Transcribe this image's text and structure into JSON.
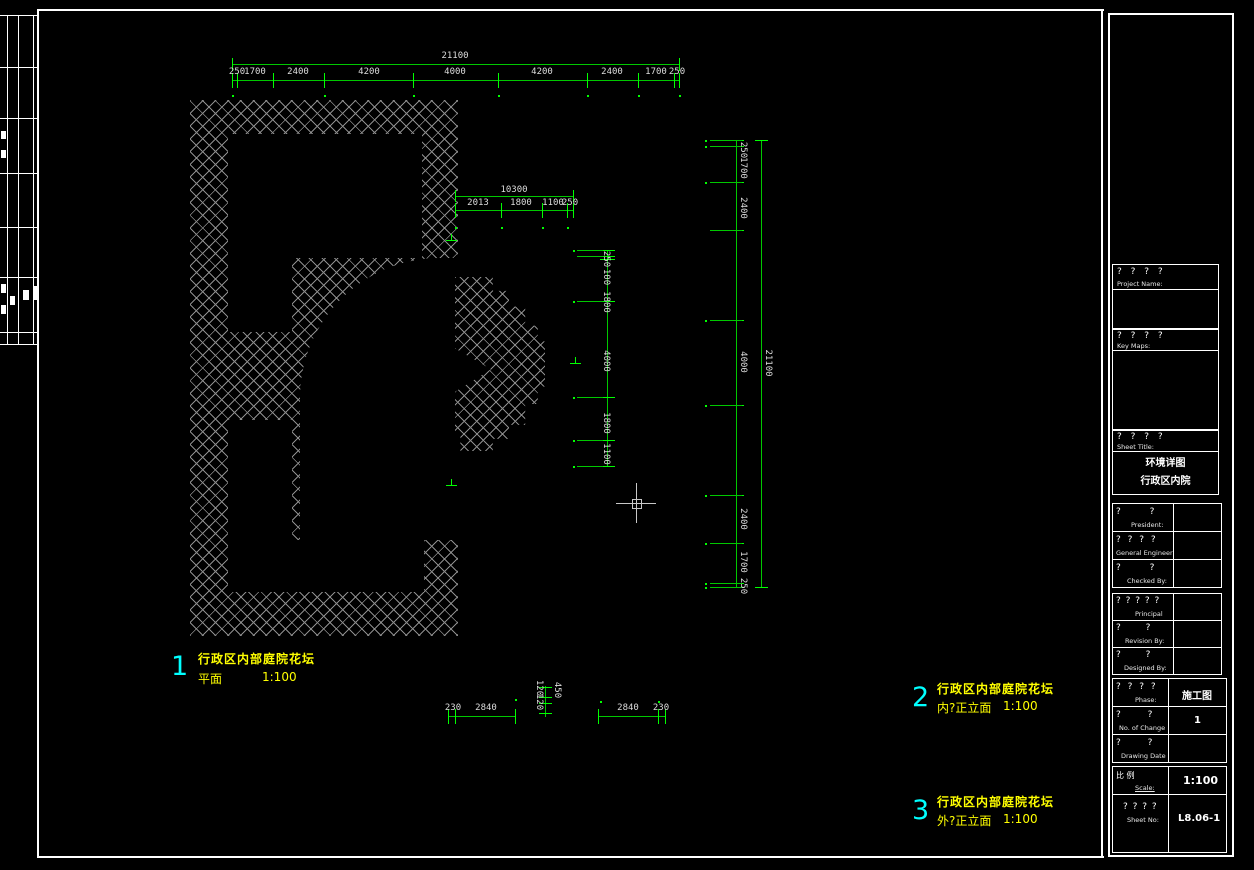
{
  "colors": {
    "background": "#000000",
    "dim_line_green": "#00c800",
    "dim_text": "#dcdcdc",
    "hatch_gray": "#8c8c8c",
    "callout_yellow": "#ffff00",
    "callout_cyan": "#00ffff",
    "frame_white": "#ffffff"
  },
  "plan": {
    "dims": {
      "top": {
        "overall": "21100",
        "chain": [
          "250",
          "1700",
          "2400",
          "4200",
          "4000",
          "4200",
          "2400",
          "1700",
          "250"
        ]
      },
      "mid": {
        "overall": "10300",
        "chain": [
          "2013",
          "1800",
          "1100",
          "250"
        ]
      },
      "inner_vertical": {
        "chain": [
          "250",
          "100",
          "1800",
          "4000",
          "1800",
          "1100"
        ]
      },
      "right": {
        "overall": "21100",
        "chain": [
          "250",
          "1700",
          "2400",
          "4000",
          "2400",
          "1700",
          "250"
        ]
      },
      "bottom_left": {
        "chain": [
          "230",
          "2840"
        ]
      },
      "bottom_mid": {
        "chain": [
          "120",
          "120",
          "450"
        ]
      },
      "bottom_right": {
        "chain": [
          "2840",
          "230"
        ]
      }
    },
    "callouts": [
      {
        "num": "1",
        "title": "行政区内部庭院花坛",
        "sub": "平面",
        "scale": "1:100"
      },
      {
        "num": "2",
        "title": "行政区内部庭院花坛",
        "sub": "内?正立面",
        "scale": "1:100"
      },
      {
        "num": "3",
        "title": "行政区内部庭院花坛",
        "sub": "外?正立面",
        "scale": "1:100"
      }
    ]
  },
  "tb": {
    "project": {
      "q": "?  ?  ?  ?",
      "label": "Project   Name:"
    },
    "keymap": {
      "q": "?  ?  ?  ?",
      "label": "Key   Maps:"
    },
    "sheet": {
      "q": "?  ?  ?  ?",
      "label": "Sheet   Title:",
      "title_line1": "环境详图",
      "title_line2": "行政区内院"
    },
    "people1": [
      {
        "q": "?       ?",
        "label": "President:"
      },
      {
        "q": "?  ?  ?  ?",
        "label": "General Engineer:"
      },
      {
        "q": "?       ?",
        "label": "Checked  By:"
      }
    ],
    "people2": [
      {
        "q": "? ? ? ? ?",
        "label": "Principal"
      },
      {
        "q": "?      ?",
        "label": "Revision  By:"
      },
      {
        "q": "?      ?",
        "label": "Designed  By:"
      }
    ],
    "block3": [
      {
        "q": "?  ?  ?  ?",
        "label": "Phase:",
        "value": "施工图"
      },
      {
        "q": "?      ?",
        "label": "No. of Change",
        "value": "1"
      },
      {
        "q": "?      ?",
        "label": "Drawing Date",
        "value": ""
      }
    ],
    "scale_row": {
      "q": "比       例",
      "label": "Scale:",
      "value": "1:100"
    },
    "sheetno_row": {
      "q": "? ? ? ?",
      "label": "Sheet No:",
      "value": "L8.06-1"
    }
  }
}
